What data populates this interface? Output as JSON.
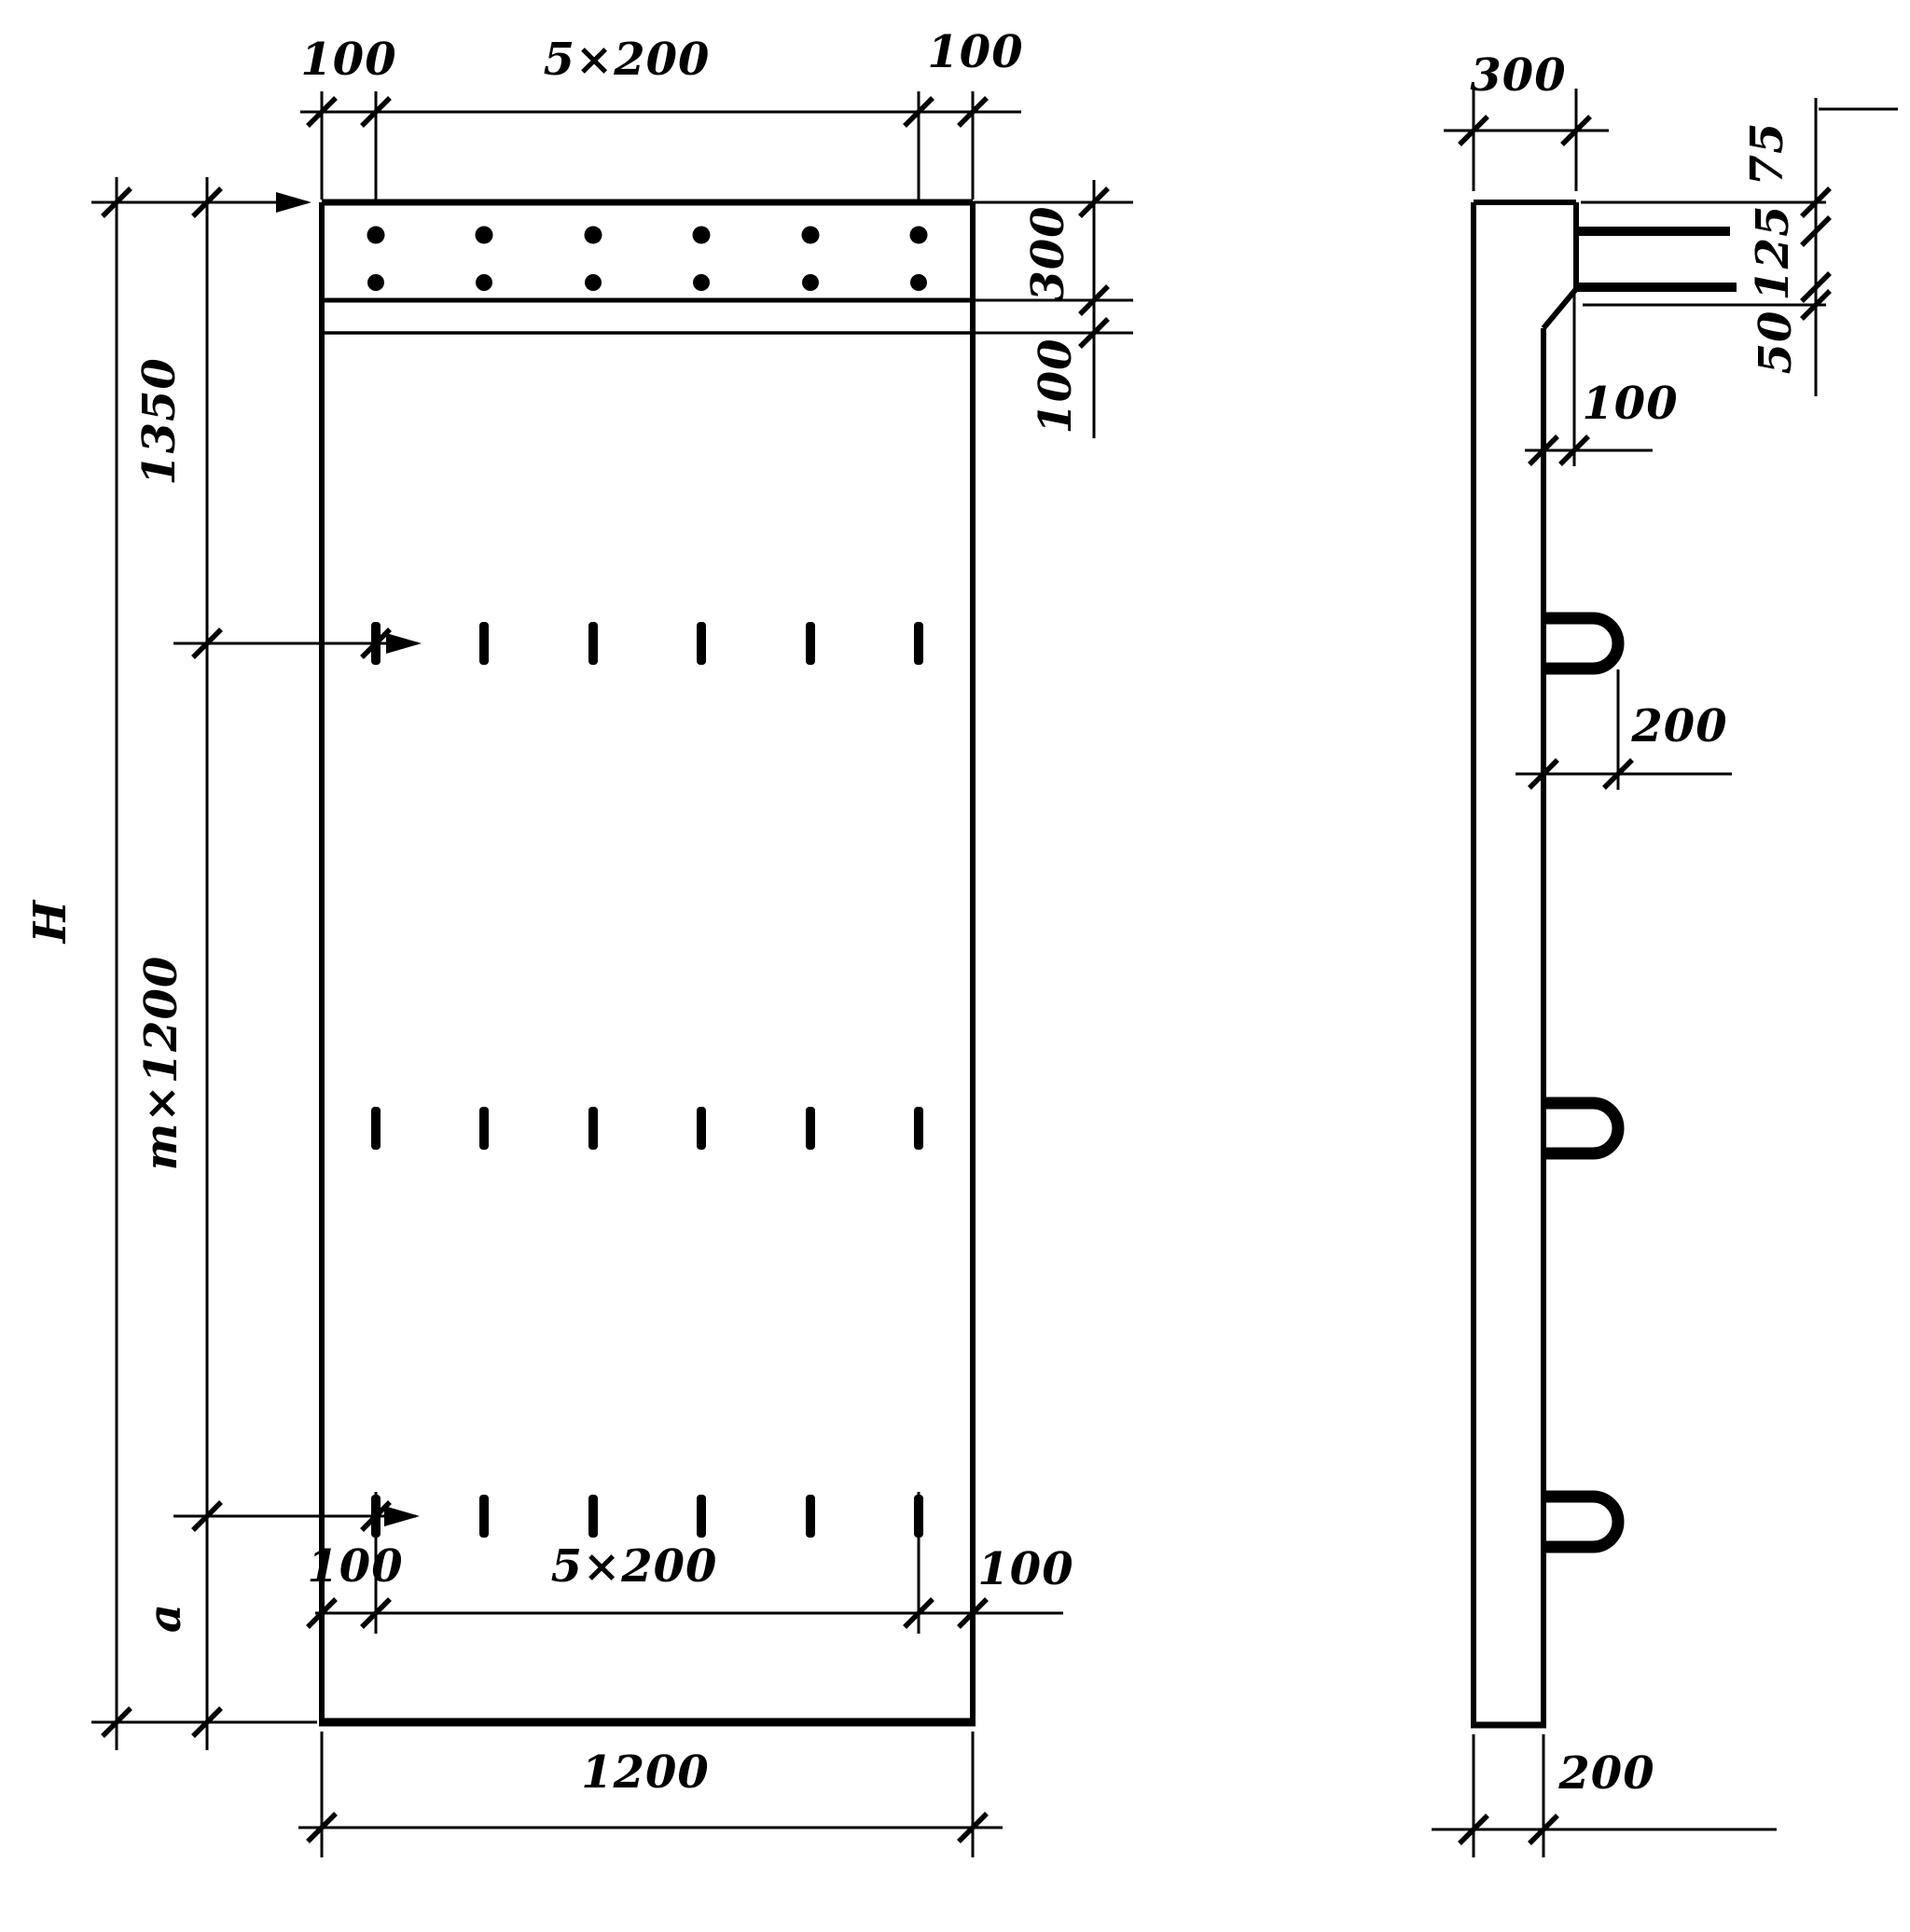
{
  "front_view": {
    "top_dim": {
      "left_offset": "100",
      "pitch": "5×200",
      "right_offset": "100"
    },
    "right_dim": {
      "band_height": "300",
      "gap": "100"
    },
    "left_dim": {
      "overall_height": "H",
      "top_segment": "1350",
      "middle_segment": "m×1200",
      "bottom_segment": "a"
    },
    "bottom_dim": {
      "left_offset": "100",
      "pitch": "5×200",
      "right_offset": "100"
    },
    "overall_width": "1200"
  },
  "side_view": {
    "top_width": "300",
    "right_dim": {
      "top": "75",
      "middle": "125",
      "bottom": "50"
    },
    "step": "100",
    "loop_projection": "200",
    "bottom_width": "200"
  }
}
